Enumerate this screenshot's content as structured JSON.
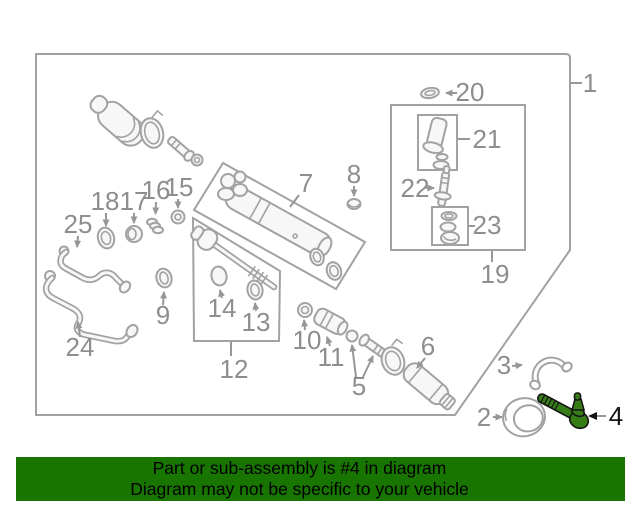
{
  "banner": {
    "line1": "Part or sub-assembly is #4 in diagram",
    "line2": "Diagram may not be specific to your vehicle",
    "bg_color": "#187500",
    "text_color": "#000000"
  },
  "highlighted_part": "4",
  "colors": {
    "diagram_line_gray": "#a2a2a2",
    "callout_label_gray": "#8e8e8e",
    "highlight_green": "#377d17",
    "highlight_outline": "#141414",
    "panel_background": "#f7f7f7"
  },
  "callouts": {
    "c1": "1",
    "c2": "2",
    "c3": "3",
    "c4": "4",
    "c5": "5",
    "c6": "6",
    "c7": "7",
    "c8": "8",
    "c9": "9",
    "c10": "10",
    "c11": "11",
    "c12": "12",
    "c13": "13",
    "c14": "14",
    "c15": "15",
    "c16": "16",
    "c17": "17",
    "c18": "18",
    "c19": "19",
    "c20": "20",
    "c21": "21",
    "c22": "22",
    "c23": "23",
    "c24": "24",
    "c25": "25"
  }
}
